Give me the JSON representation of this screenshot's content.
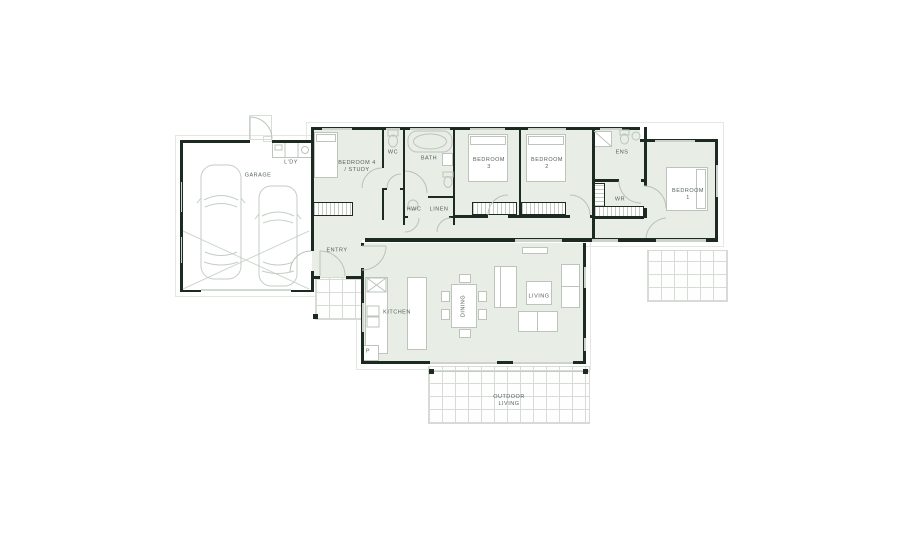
{
  "plan": {
    "type": "residential-floor-plan",
    "rooms": {
      "garage": "GARAGE",
      "laundry": "L'DY",
      "bedroom4": "BEDROOM 4\n/ STUDY",
      "wc": "WC",
      "bath": "BATH",
      "hwc": "HWC",
      "linen": "LINEN",
      "bedroom3": "BEDROOM\n3",
      "bedroom2": "BEDROOM\n2",
      "ens": "ENS",
      "wr": "WR",
      "bedroom1": "BEDROOM\n1",
      "entry": "ENTRY",
      "kitchen": "KITCHEN",
      "dining": "DINING",
      "living": "LIVING",
      "outdoor_living": "OUTDOOR\nLIVING",
      "pantry": "P"
    },
    "colors": {
      "wall": "#1c2a21",
      "interior_fill": "#e8eee6",
      "furniture_line": "#bcc4bc",
      "grid_line": "#d6dcd5",
      "label_text": "#55605a"
    }
  }
}
